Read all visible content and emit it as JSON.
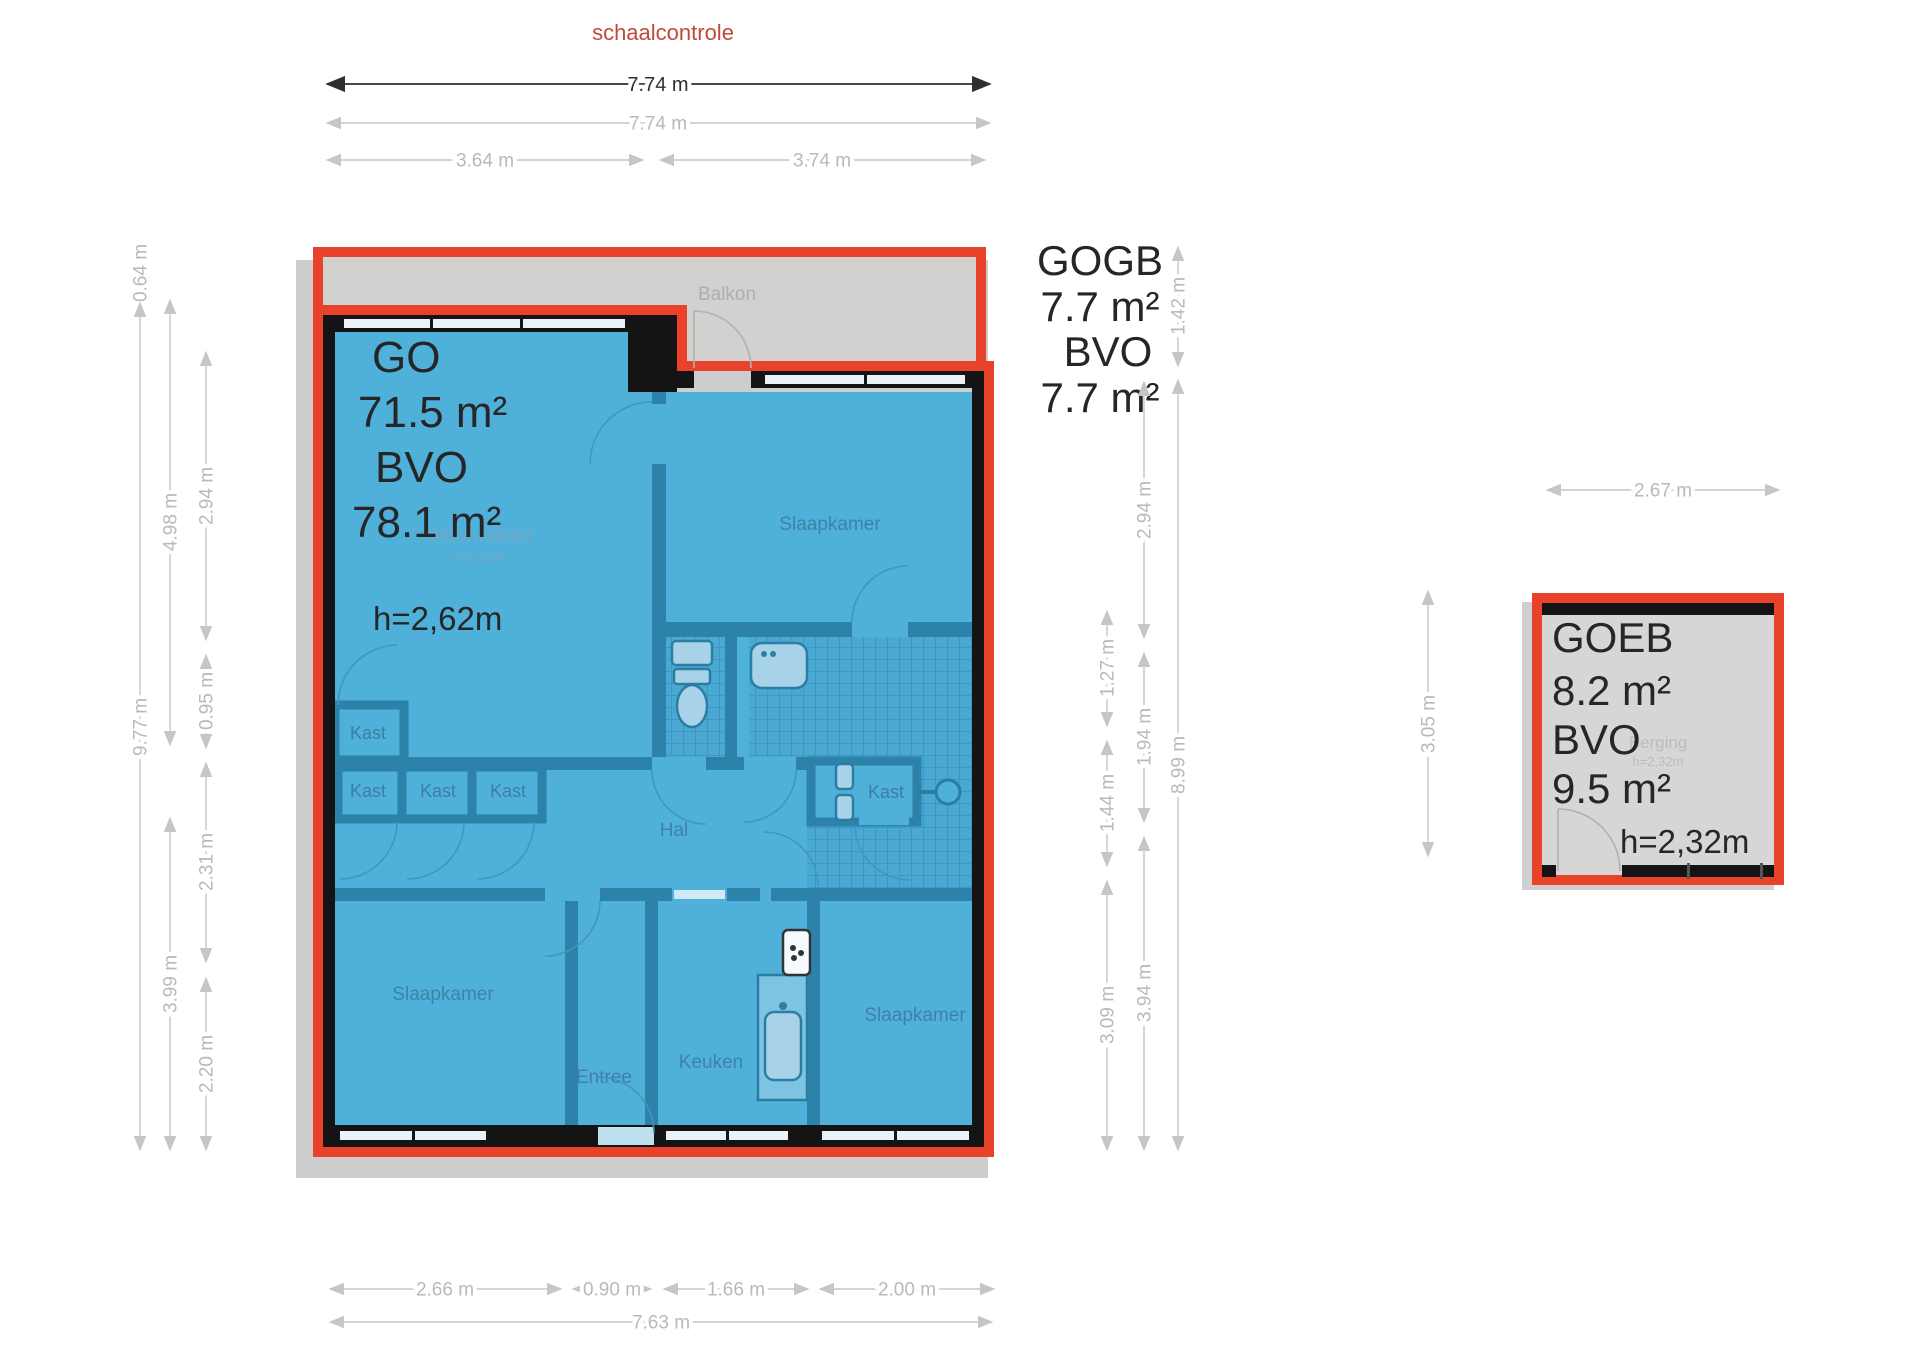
{
  "note": {
    "scale_check": "schaalcontrole"
  },
  "colors": {
    "outline_red": "#e8432a",
    "floor_blue": "#4fb0da",
    "outer_wall_black": "#141414",
    "inner_wall_teal": "#2c82a8",
    "balcony_gray": "#d2d1d0",
    "note_text_red": "#bf4a3b",
    "dim_dark": "#2f2f2f",
    "dim_light": "#c2c2c2",
    "room_label_blue": "#3f82a8"
  },
  "areas": {
    "main": {
      "lines": [
        "GO",
        "71.5 m²",
        "BVO",
        "78.1 m²"
      ],
      "height": "h=2,62m"
    },
    "balcony": {
      "lines": [
        "GOGB",
        "7.7 m²",
        "BVO",
        "7.7 m²"
      ]
    },
    "storage": {
      "lines": [
        "GOEB",
        "8.2 m²",
        "BVO",
        "9.5 m²"
      ],
      "height": "h=2,32m"
    }
  },
  "rooms": {
    "balkon": "Balkon",
    "woonkamer": "Woonkamer",
    "woonkamer_h": "h=2,62m",
    "slaapkamer_ne": "Slaapkamer",
    "slaapkamer_sw": "Slaapkamer",
    "slaapkamer_se": "Slaapkamer",
    "hal": "Hal",
    "entree": "Entree",
    "keuken": "Keuken",
    "kast": [
      "Kast",
      "Kast",
      "Kast",
      "Kast",
      "Kast"
    ],
    "berging": "Berging",
    "berging_h": "h=2,32m"
  },
  "dims": {
    "top": [
      "7.74 m",
      "7.74 m",
      "3.64 m",
      "3.74 m"
    ],
    "left": [
      "0.64 m",
      "9.77 m",
      "4.98 m",
      "3.99 m",
      "2.94 m",
      "0.95 m",
      "2.31 m",
      "2.20 m"
    ],
    "right": [
      "1.27 m",
      "1.44 m",
      "3.09 m",
      "2.94 m",
      "1.94 m",
      "3.94 m",
      "1.42 m",
      "8.99 m"
    ],
    "bottom": [
      "2.66 m",
      "0.90 m",
      "1.66 m",
      "2.00 m",
      "7.63 m"
    ],
    "storage": [
      "2.67 m",
      "3.05 m"
    ]
  }
}
